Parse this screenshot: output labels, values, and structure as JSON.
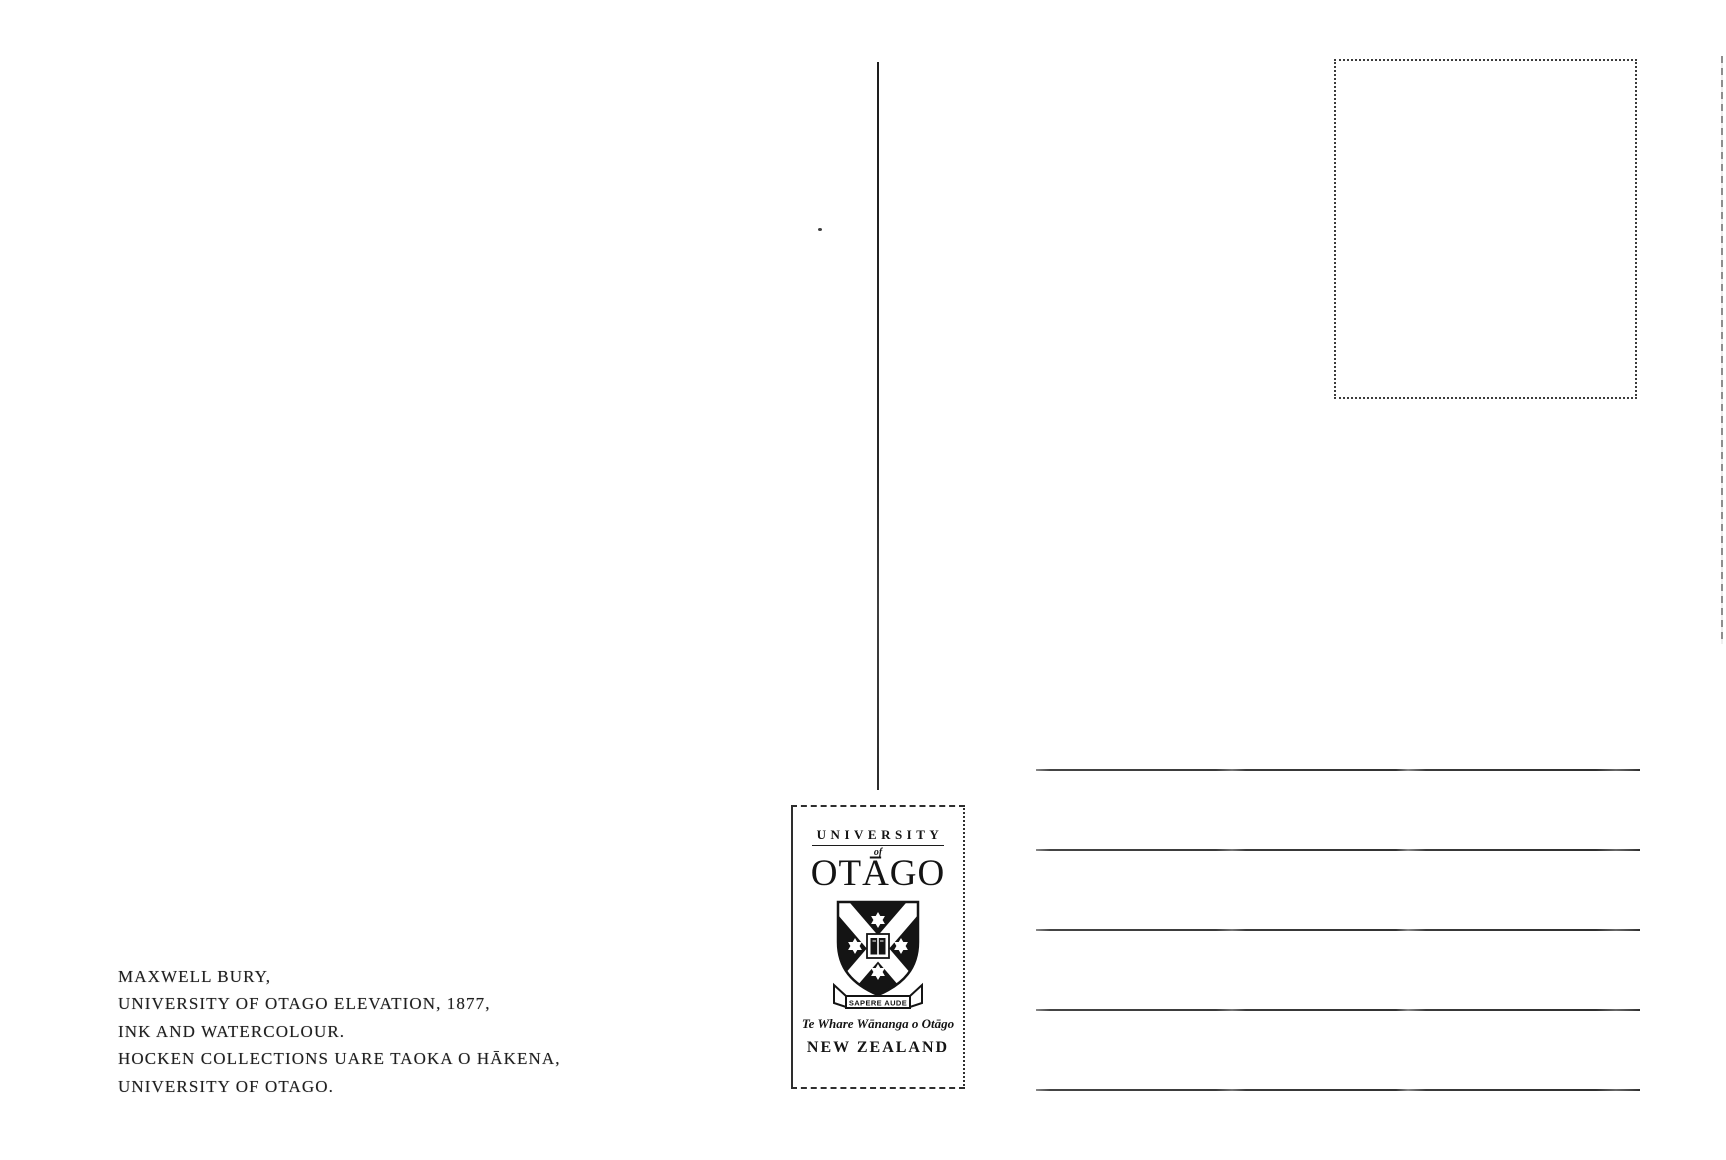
{
  "postcard": {
    "caption": {
      "lines": [
        "MAXWELL BURY,",
        "UNIVERSITY OF OTAGO ELEVATION, 1877,",
        "INK AND WATERCOLOUR.",
        "HOCKEN COLLECTIONS UARE TAOKA O HĀKENA,",
        "UNIVERSITY OF OTAGO."
      ]
    },
    "logo": {
      "university": "UNIVERSITY",
      "of": "of",
      "otago": "OTĀGO",
      "motto": "SAPERE AUDE",
      "maori_name": "Te Whare Wānanga o Otāgo",
      "country": "NEW ZEALAND"
    },
    "address_line_count": 5,
    "colors": {
      "ink": "#1f1f1f",
      "background": "#ffffff"
    }
  }
}
